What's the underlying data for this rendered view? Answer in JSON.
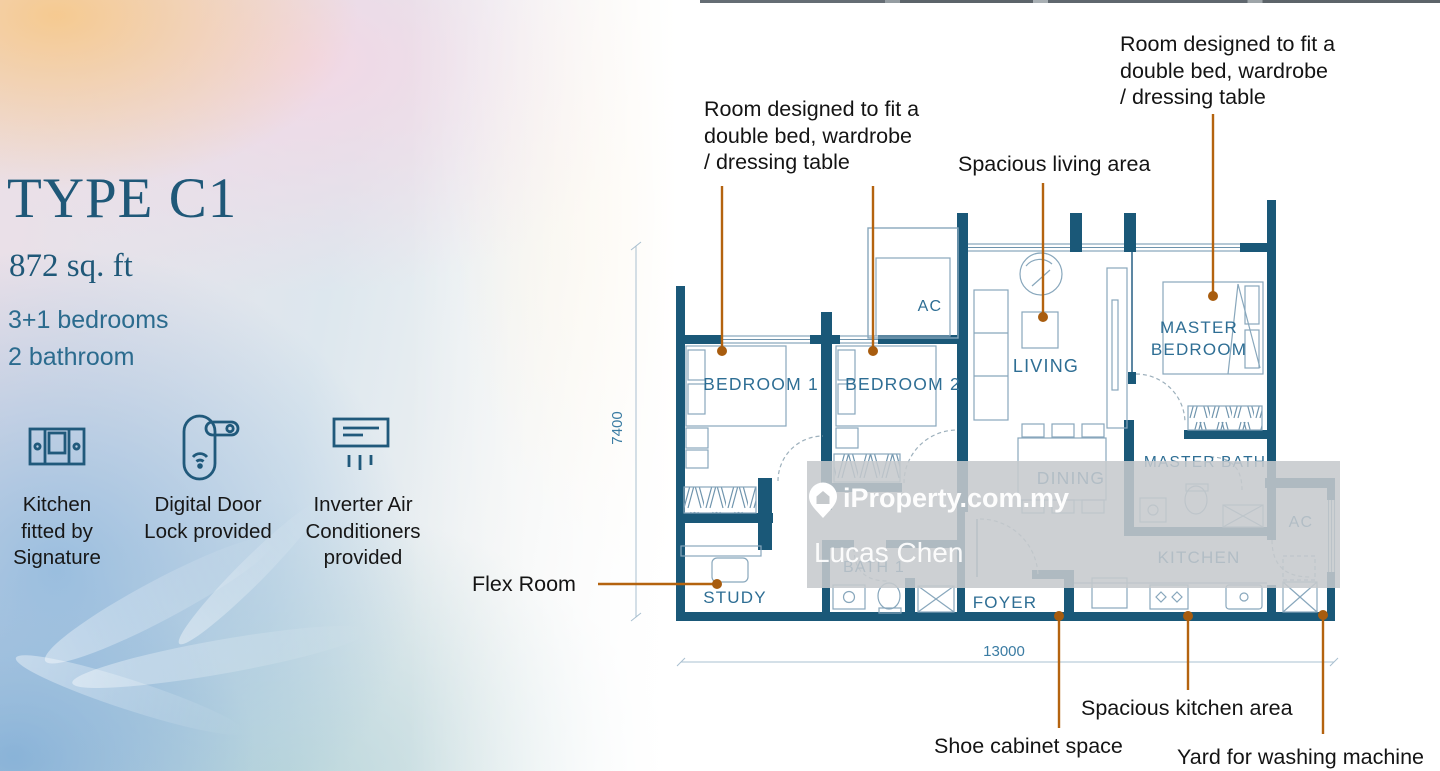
{
  "left_panel": {
    "title": "TYPE C1",
    "area": "872 sq. ft",
    "bedrooms": "3+1 bedrooms",
    "bathrooms": "2 bathroom",
    "features": [
      {
        "icon": "kitchen-cabinet-icon",
        "line1": "Kitchen",
        "line2": "fitted by",
        "line3": "Signature"
      },
      {
        "icon": "door-lock-icon",
        "line1": "Digital Door",
        "line2": "Lock",
        "line3": "provided"
      },
      {
        "icon": "air-conditioner-icon",
        "line1": "Inverter Air",
        "line2": "Conditioners",
        "line3": "provided"
      }
    ]
  },
  "annotations": {
    "note_left": {
      "line1": "Room designed to fit a",
      "line2": "double bed, wardrobe",
      "line3": "/ dressing table"
    },
    "note_right": {
      "line1": "Room designed to fit a",
      "line2": "double bed, wardrobe",
      "line3": "/ dressing table"
    },
    "living": "Spacious living area",
    "flex": "Flex Room",
    "shoe": "Shoe cabinet space",
    "kitchen": "Spacious kitchen area",
    "yard": "Yard for washing machine"
  },
  "plan": {
    "rooms": {
      "bedroom1": "BEDROOM 1",
      "bedroom2": "BEDROOM 2",
      "ac_top": "AC",
      "living": "LIVING",
      "master_line1": "MASTER",
      "master_line2": "BEDROOM",
      "dining": "DINING",
      "master_bath": "MASTER BATH",
      "bath1": "BATH 1",
      "study": "STUDY",
      "foyer": "FOYER",
      "kitchen": "KITCHEN",
      "ac_yard": "AC"
    },
    "dimensions": {
      "width_mm": "13000",
      "height_mm": "7400"
    },
    "colors": {
      "wall": "#1a5878",
      "furniture_line": "#88a7bc",
      "room_label": "#2e6e94",
      "leader": "#b4630f",
      "dimension": "#3b7ca3"
    }
  },
  "watermark": {
    "brand": "iProperty.com.my",
    "agent": "Lucas Chen",
    "bg": "#c5c9cc"
  }
}
